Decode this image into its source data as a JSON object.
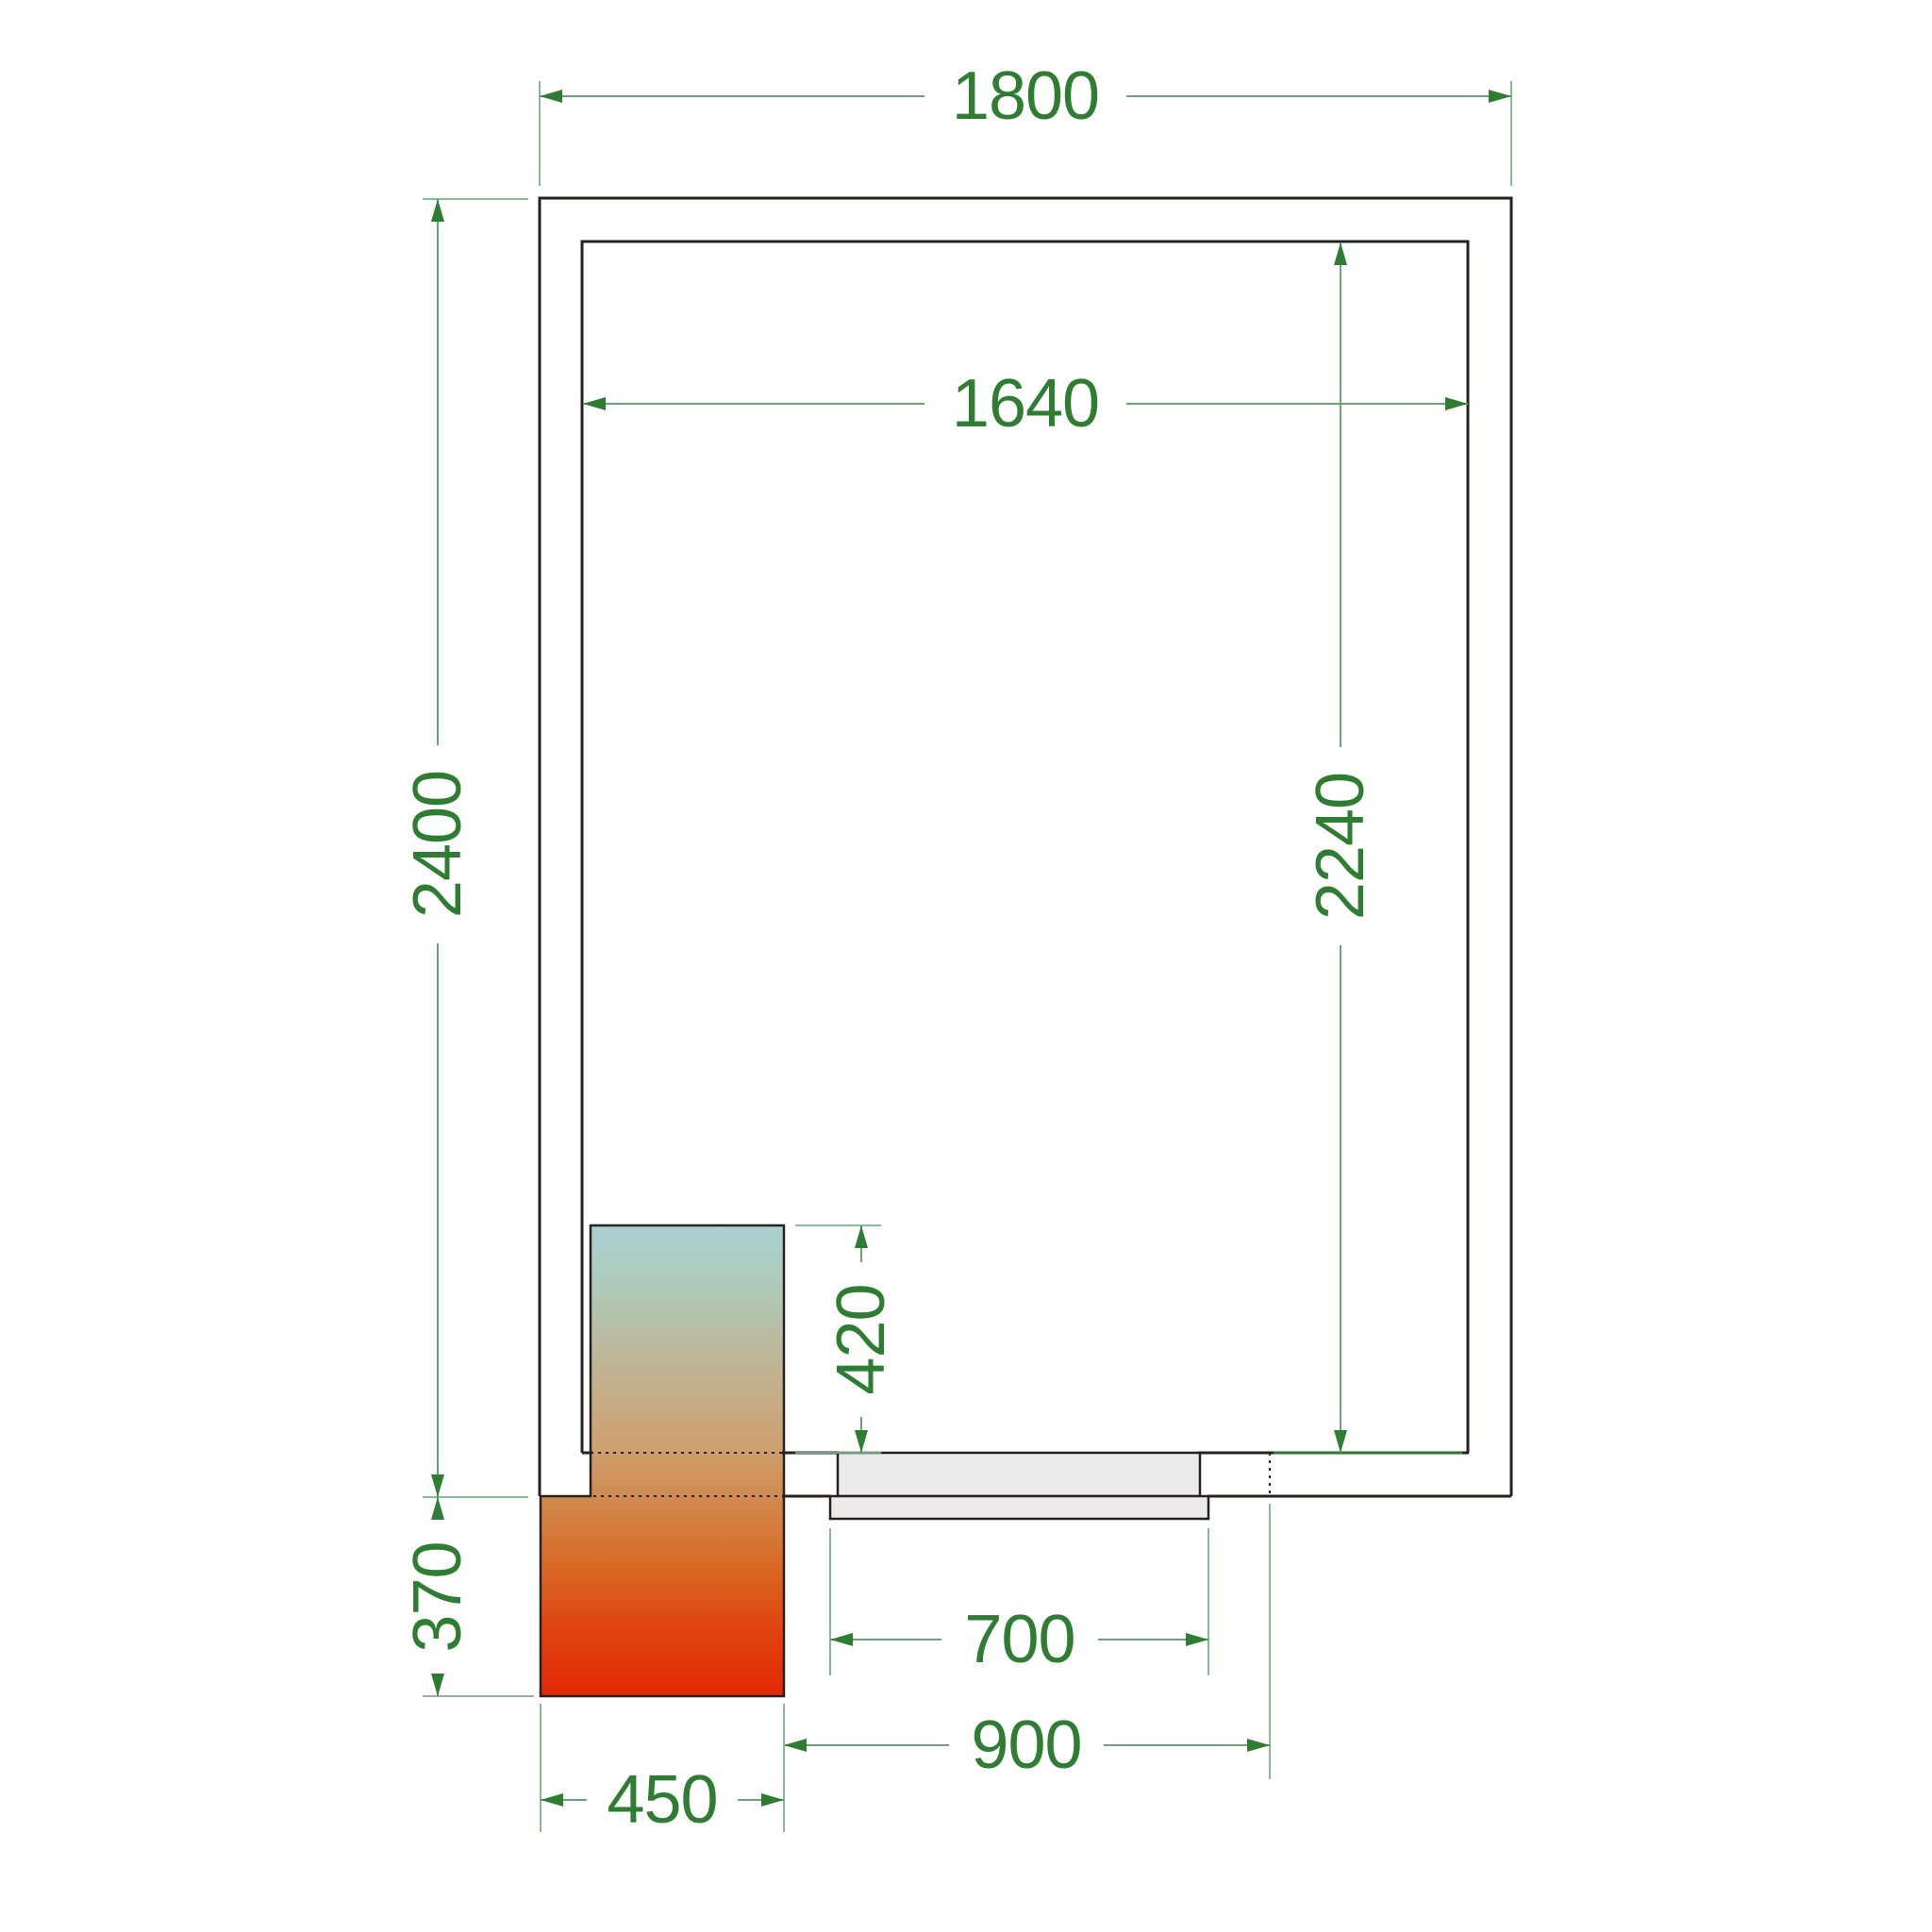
{
  "drawing": {
    "type": "cold-room-floor-plan",
    "dimensions": {
      "outer_width": "1800",
      "outer_depth": "2400",
      "inner_width": "1640",
      "inner_depth": "2240",
      "unit_length": "420",
      "unit_rear_overhang": "370",
      "door_leaf_width": "700",
      "door_opening_width": "900",
      "unit_width": "450"
    },
    "colors": {
      "dimension_text": "#2e7d32",
      "dimension_line": "#6ba278",
      "wall_line": "#272220",
      "door_fill": "#ebebeb",
      "unit_gradient": [
        "#a9d1d1",
        "#afc9b7",
        "#c0b494",
        "#cda272",
        "#d18a4e",
        "#d96a26",
        "#e0430f",
        "#e22806"
      ]
    }
  }
}
